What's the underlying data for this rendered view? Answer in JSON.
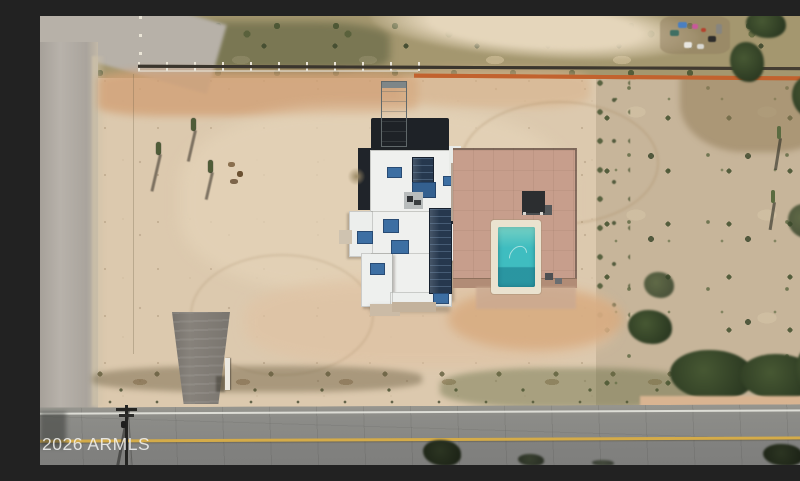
{
  "photo": {
    "kind": "aerial-photograph",
    "subject": "Overhead drone view of a desert residential lot with a white flat-roofed house with rooftop solar panels, a fenced pink-concrete pool patio with a turquoise rectangular pool, a graded tan dirt yard, natural desert scrub on the east side, fence lines along the north boundary, a gray dirt road on the west, and a paved two-lane road with a yellow center line along the bottom",
    "watermark": {
      "text": "2026 ARMLS"
    }
  },
  "palette": {
    "graded_dirt": "#dcc9ae",
    "orange_dirt": "#d2a176",
    "natural_desert": "#c7b59a",
    "vegetation_dark": "#3e5130",
    "dirt_road_gray": "#b3ada5",
    "asphalt": "#8a8a87",
    "center_line_yellow": "#d4ab49",
    "edge_line_white": "#efefe9",
    "roof_white": "#eff0ee",
    "roof_dark": "#1e2227",
    "solar_panel_blue": "#26384e",
    "skylight_blue": "#3d6fa3",
    "pool_water": "#3fbdc0",
    "pool_coping": "#eae2cf",
    "patio_pink": "#c79e8c",
    "gravel_driveway": "#87827b",
    "fence_dark": "#3a352d",
    "silt_fence_orange": "#c2622e"
  }
}
